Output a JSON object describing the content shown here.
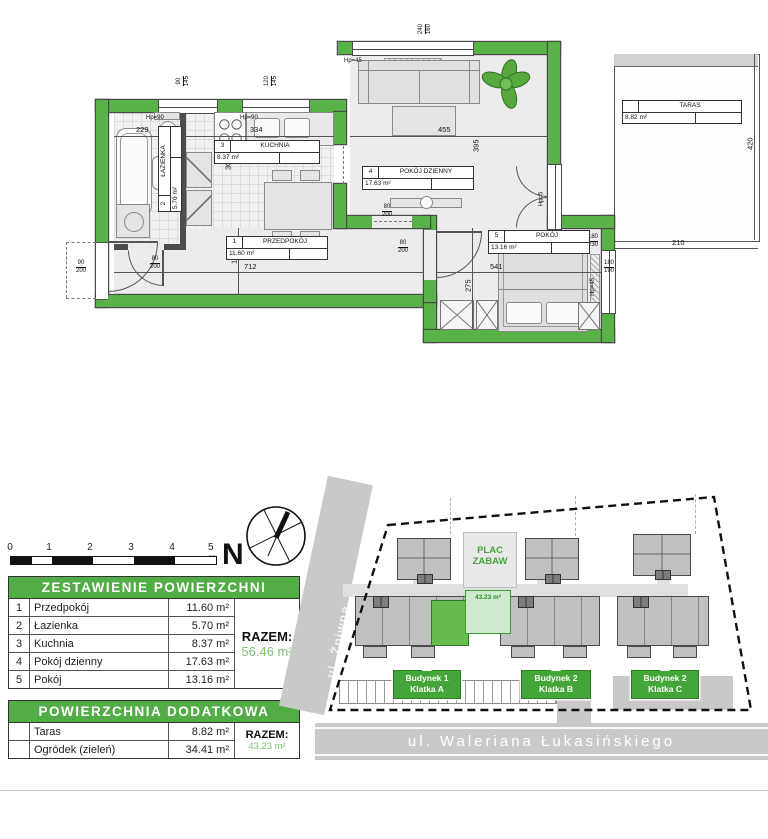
{
  "floor_plan": {
    "rooms": {
      "hall": {
        "no": "1",
        "name": "PRZEDPOKÓJ",
        "area": "11.60 m²"
      },
      "bath": {
        "no": "2",
        "name": "ŁAZIENKA",
        "area": "5.70 m²"
      },
      "kitchen": {
        "no": "3",
        "name": "KUCHNIA",
        "area": "8.37 m²"
      },
      "living": {
        "no": "4",
        "name": "POKÓJ DZIENNY",
        "area": "17.63 m²"
      },
      "bedroom": {
        "no": "5",
        "name": "POKÓJ",
        "area": "13.16 m²"
      },
      "terrace": {
        "no": "",
        "name": "TARAS",
        "area": "8.82 m²"
      }
    },
    "dims": {
      "a229": "229",
      "a334": "334",
      "a455": "455",
      "v395": "395",
      "v300": "300",
      "v155": "155",
      "h712": "712",
      "h541": "541",
      "v275": "275",
      "h210": "210",
      "v420": "420"
    },
    "windows": {
      "bath": {
        "t": "90",
        "b": "145"
      },
      "kitchen": {
        "t": "120",
        "b": "145"
      },
      "living": {
        "t": "240",
        "b": "160"
      },
      "bedroom": {
        "t": "180",
        "b": "190"
      },
      "balcony": {
        "t": "180",
        "b": "230"
      }
    },
    "doors": {
      "bath": {
        "t": "80",
        "b": "200"
      },
      "living": {
        "t": "80",
        "b": "200"
      },
      "bedroom": {
        "t": "80",
        "b": "200"
      },
      "entry": {
        "t": "90",
        "b": "200"
      }
    },
    "heights": {
      "hp90a": "Hp=90",
      "hp90b": "Hp=90",
      "hp45a": "Hp=45",
      "hp45b": "Hp=45",
      "hp5": "Hp=5"
    }
  },
  "scale_bar": {
    "labels": [
      "0",
      "1",
      "2",
      "3",
      "4",
      "5 m"
    ]
  },
  "compass": {
    "n": "N"
  },
  "area_table": {
    "title": "ZESTAWIENIE POWIERZCHNI",
    "rows": [
      {
        "no": "1",
        "name": "Przedpokój",
        "area": "11.60 m²"
      },
      {
        "no": "2",
        "name": "Łazienka",
        "area": "5.70 m²"
      },
      {
        "no": "3",
        "name": "Kuchnia",
        "area": "8.37 m²"
      },
      {
        "no": "4",
        "name": "Pokój dzienny",
        "area": "17.63 m²"
      },
      {
        "no": "5",
        "name": "Pokój",
        "area": "13.16 m²"
      }
    ],
    "total_label": "RAZEM:",
    "total": "56.46 m²"
  },
  "extra_table": {
    "title": "POWIERZCHNIA DODATKOWA",
    "rows": [
      {
        "no": "",
        "name": "Taras",
        "area": "8.82 m²"
      },
      {
        "no": "",
        "name": "Ogródek (zieleń)",
        "area": "34.41 m²"
      }
    ],
    "total_label": "RAZEM:",
    "total": "43.23 m²"
  },
  "site_plan": {
    "street_left": "ul. Żniwna",
    "street_bottom": "ul. Waleriana Łukasińskiego",
    "playground": {
      "l1": "PLAC",
      "l2": "ZABAW"
    },
    "garden_area": "43.23 m²",
    "badges": [
      {
        "l1": "Budynek 1",
        "l2": "Klatka A"
      },
      {
        "l1": "Budynek 2",
        "l2": "Klatka B"
      },
      {
        "l1": "Budynek 2",
        "l2": "Klatka C"
      }
    ]
  },
  "colors": {
    "wall_green": "#58b247",
    "header_green": "#53ad47",
    "accent_green": "#44a539",
    "total_green": "#7cc06c"
  }
}
